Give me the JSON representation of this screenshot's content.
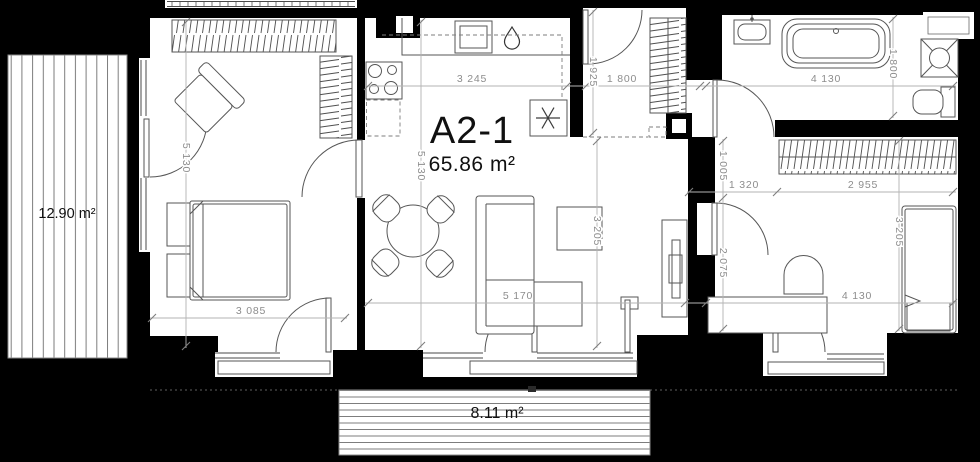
{
  "unit": {
    "title": "A2-1",
    "area": "65.86 m²"
  },
  "terraces": {
    "left": "12.90 m²",
    "bottom": "8.11 m²"
  },
  "dims": {
    "bedroom1_h": "5 130",
    "bedroom1_w": "3 085",
    "kitchen_w": "3 245",
    "living_h": "5 130",
    "living_w": "5 170",
    "living_d": "3 205",
    "entry": "1 925",
    "hall_w": "1 800",
    "nook": "1 005",
    "b2_entry": "1 320",
    "b2_wardrobe": "2 955",
    "b2_w": "4 130",
    "b2_h": "3 205",
    "b2_wall": "2 075",
    "bath_w": "4 130",
    "bath_d": "1 800"
  },
  "icons": {
    "water_drop": "water-drop-icon",
    "appliance": "appliance-asterisk-icon"
  },
  "colors": {
    "wall": "#000000",
    "floor": "#ffffff",
    "furniture": "#565656",
    "dim_line": "#b3b3b3",
    "dim_text": "#8d8d8d",
    "label_text": "#101010"
  }
}
